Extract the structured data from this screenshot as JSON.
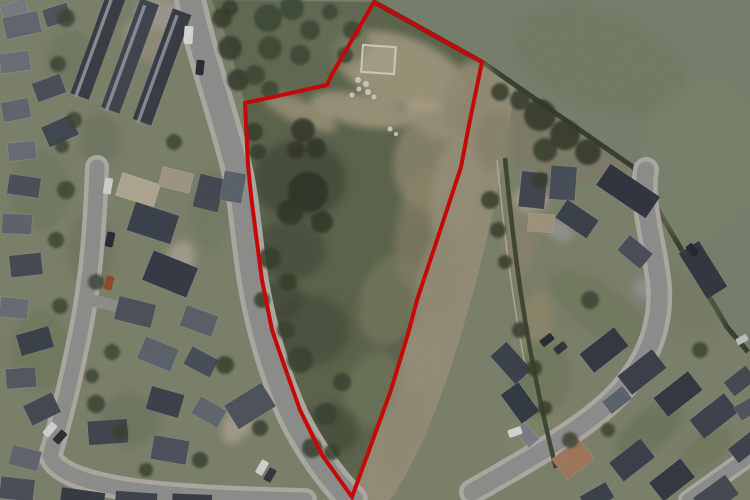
{
  "image": {
    "kind": "aerial-photograph",
    "width": 750,
    "height": 500
  },
  "palette": {
    "boundary_red": "#e30b0b",
    "pasture_green": "#87917a",
    "site_scrub": "#697257",
    "scrub_dark": "#49523d",
    "bare_earth": "#b6ab8e",
    "dry_grass_strip": "#a79f87",
    "road_grey": "#a1a19f",
    "roof_dark": "#3f4450",
    "garden_base": "#8d9279"
  },
  "site_boundary": {
    "stroke_width": "4",
    "points": "374,2 482,62 470,120 461,167 437,240 417,300 408,334 391,390 371,445 352,497 322,455 300,410 283,362 272,330 262,280 256,235 251,195 248,165 245,103 327,85 331,76"
  },
  "features": {
    "pasture": {
      "points": "360,0 750,0 750,352 727,327 700,270 660,205 633,167 482,62 374,2"
    },
    "pasture_hedge": {
      "d": "M374,2 L482,62 L633,167 L727,327 L748,352"
    },
    "scrub_north": {
      "points": "212,0 374,2 331,76 327,85 245,103 228,42"
    },
    "strip_triangle": {
      "points": "482,62 633,167 540,198 488,120"
    },
    "strip_brush": {
      "d": "M478,64 C470,140 452,230 424,322 C410,370 390,428 362,472"
    },
    "main_road": {
      "d": "M190,0 C202,55 220,105 235,162 C244,196 246,238 253,282 C261,328 274,374 293,416 C312,454 332,480 352,500"
    },
    "west_street": {
      "d": "M97,167 C95,225 91,285 77,348 C68,392 60,424 50,456 C58,476 100,488 170,494 C220,498 265,499 305,500"
    },
    "west_branch": {
      "d": "M90,300 L146,313"
    },
    "east_road": {
      "d": "M646,170 C640,205 656,248 659,288 C661,326 648,362 618,394 C588,426 532,458 472,492"
    },
    "spur_road": {
      "d": "M688,500 L750,456"
    },
    "east_hedge": {
      "d": "M505,158 C512,230 520,300 535,375 C544,420 550,445 556,468"
    },
    "east_fence": {
      "d": "M497,160 C504,232 512,300 527,375"
    }
  },
  "shapes": {
    "houses": [
      [
        2,
        2,
        26,
        18,
        -20,
        "#878c94"
      ],
      [
        4,
        14,
        36,
        22,
        -12,
        "#70757f"
      ],
      [
        44,
        6,
        26,
        18,
        -18,
        "#5a606b"
      ],
      [
        0,
        52,
        30,
        20,
        -8,
        "#7a7f88"
      ],
      [
        34,
        78,
        30,
        20,
        -20,
        "#555b66"
      ],
      [
        2,
        100,
        28,
        20,
        -10,
        "#6e747e"
      ],
      [
        44,
        120,
        32,
        22,
        -24,
        "#4c525d"
      ],
      [
        8,
        142,
        28,
        18,
        -6,
        "#767b84"
      ],
      [
        88,
        -8,
        20,
        108,
        20,
        "#43484f"
      ],
      [
        120,
        -2,
        20,
        116,
        20,
        "#4a4f58"
      ],
      [
        152,
        8,
        20,
        118,
        20,
        "#41464f"
      ],
      [
        92,
        -4,
        3,
        104,
        20,
        "#9aa0a8"
      ],
      [
        124,
        2,
        3,
        112,
        20,
        "#9aa0a8"
      ],
      [
        156,
        12,
        3,
        114,
        20,
        "#959ba3"
      ],
      [
        8,
        176,
        32,
        20,
        8,
        "#565c67"
      ],
      [
        2,
        214,
        30,
        20,
        2,
        "#6d727c"
      ],
      [
        10,
        254,
        32,
        22,
        -6,
        "#4f555f"
      ],
      [
        0,
        298,
        28,
        20,
        6,
        "#777c85"
      ],
      [
        18,
        330,
        34,
        22,
        -16,
        "#454b56"
      ],
      [
        6,
        368,
        30,
        20,
        -4,
        "#5f656f"
      ],
      [
        26,
        398,
        32,
        22,
        -26,
        "#50565f"
      ],
      [
        118,
        178,
        40,
        24,
        18,
        "#c7bda6"
      ],
      [
        160,
        170,
        32,
        20,
        14,
        "#b5ab94"
      ],
      [
        130,
        208,
        46,
        30,
        18,
        "#454b57"
      ],
      [
        146,
        258,
        48,
        32,
        22,
        "#3e4450"
      ],
      [
        116,
        300,
        38,
        24,
        14,
        "#575d68"
      ],
      [
        196,
        176,
        26,
        34,
        14,
        "#4f555e"
      ],
      [
        222,
        172,
        22,
        30,
        10,
        "#6a707a"
      ],
      [
        182,
        310,
        34,
        22,
        20,
        "#6a6f79"
      ],
      [
        140,
        342,
        36,
        24,
        22,
        "#6a707a"
      ],
      [
        186,
        352,
        30,
        20,
        28,
        "#545a65"
      ],
      [
        148,
        390,
        34,
        24,
        16,
        "#464c57"
      ],
      [
        194,
        402,
        30,
        20,
        30,
        "#6e747e"
      ],
      [
        152,
        438,
        36,
        24,
        10,
        "#575d68"
      ],
      [
        228,
        392,
        44,
        28,
        -32,
        "#5a6069"
      ],
      [
        88,
        420,
        40,
        24,
        -4,
        "#4a505b"
      ],
      [
        60,
        490,
        44,
        24,
        8,
        "#3e444f"
      ],
      [
        115,
        492,
        42,
        22,
        4,
        "#474d58"
      ],
      [
        172,
        494,
        40,
        20,
        2,
        "#3f4550"
      ],
      [
        10,
        448,
        30,
        20,
        14,
        "#6e747e"
      ],
      [
        0,
        478,
        34,
        22,
        6,
        "#555b66"
      ],
      [
        520,
        172,
        26,
        36,
        6,
        "#4a505c"
      ],
      [
        550,
        166,
        26,
        34,
        4,
        "#545a65"
      ],
      [
        598,
        178,
        60,
        26,
        34,
        "#383e49"
      ],
      [
        558,
        208,
        38,
        22,
        34,
        "#454b55"
      ],
      [
        528,
        214,
        26,
        18,
        4,
        "#b3a78d"
      ],
      [
        676,
        258,
        54,
        24,
        58,
        "#3a404b"
      ],
      [
        620,
        242,
        30,
        20,
        40,
        "#555b66"
      ],
      [
        582,
        338,
        44,
        24,
        -38,
        "#3b414c"
      ],
      [
        620,
        360,
        44,
        24,
        -38,
        "#434955"
      ],
      [
        656,
        382,
        44,
        24,
        -38,
        "#3b414c"
      ],
      [
        692,
        404,
        44,
        24,
        -38,
        "#474d58"
      ],
      [
        604,
        392,
        26,
        16,
        -38,
        "#6a707a"
      ],
      [
        726,
        372,
        28,
        18,
        -38,
        "#50565f"
      ],
      [
        492,
        352,
        38,
        22,
        48,
        "#454b56"
      ],
      [
        502,
        392,
        36,
        22,
        54,
        "#3d434e"
      ],
      [
        516,
        428,
        22,
        14,
        48,
        "#8b9096"
      ],
      [
        556,
        446,
        34,
        26,
        -38,
        "#b5886a"
      ],
      [
        612,
        448,
        40,
        24,
        -38,
        "#434955"
      ],
      [
        652,
        468,
        40,
        24,
        -38,
        "#3b414c"
      ],
      [
        696,
        484,
        40,
        24,
        -36,
        "#50565f"
      ],
      [
        730,
        438,
        30,
        18,
        -38,
        "#474d58"
      ],
      [
        582,
        488,
        30,
        18,
        -30,
        "#454b56"
      ],
      [
        736,
        400,
        24,
        16,
        -30,
        "#5c626c"
      ]
    ],
    "patches": [
      [
        400,
        70,
        70,
        34,
        20,
        "#b6ab8e",
        0.9
      ],
      [
        360,
        110,
        50,
        16,
        12,
        "#bdb294",
        0.8
      ],
      [
        300,
        112,
        40,
        12,
        25,
        "#b2a78a",
        0.8
      ],
      [
        432,
        120,
        30,
        16,
        30,
        "#c3b79a",
        0.8
      ],
      [
        430,
        160,
        36,
        50,
        10,
        "#a89e83",
        0.7
      ],
      [
        420,
        230,
        24,
        60,
        8,
        "#a29877",
        0.55
      ],
      [
        390,
        300,
        30,
        46,
        14,
        "#8d9070",
        0.6
      ],
      [
        372,
        390,
        26,
        40,
        18,
        "#87906e",
        0.5
      ],
      [
        300,
        180,
        46,
        40,
        0,
        "#49523d",
        0.75
      ],
      [
        290,
        250,
        36,
        30,
        0,
        "#4d5741",
        0.7
      ],
      [
        310,
        330,
        40,
        36,
        0,
        "#4b5540",
        0.6
      ],
      [
        330,
        430,
        30,
        26,
        0,
        "#49533e",
        0.6
      ],
      [
        280,
        300,
        24,
        20,
        0,
        "#434d39",
        0.6
      ],
      [
        470,
        100,
        26,
        40,
        12,
        "#a59d84",
        0.9
      ],
      [
        455,
        190,
        24,
        56,
        10,
        "#aaa189",
        0.9
      ],
      [
        440,
        280,
        22,
        56,
        12,
        "#a59d84",
        0.85
      ],
      [
        425,
        360,
        20,
        48,
        16,
        "#a89f86",
        0.85
      ],
      [
        405,
        430,
        18,
        40,
        22,
        "#a49b82",
        0.8
      ],
      [
        495,
        140,
        20,
        30,
        10,
        "#979478",
        0.8
      ],
      [
        520,
        240,
        16,
        40,
        6,
        "#9c957c",
        0.8
      ],
      [
        535,
        330,
        16,
        40,
        10,
        "#a09879",
        0.8
      ],
      [
        548,
        410,
        14,
        34,
        12,
        "#9d9579",
        0.8
      ],
      [
        530,
        440,
        30,
        24,
        0,
        "#8f9778",
        0.9
      ],
      [
        162,
        14,
        26,
        16,
        14,
        "#b2aea4",
        0.9
      ],
      [
        150,
        40,
        30,
        20,
        20,
        "#b5ab97",
        0.5
      ],
      [
        280,
        30,
        40,
        30,
        0,
        "#6f7a5e",
        0.8
      ],
      [
        340,
        40,
        30,
        26,
        0,
        "#747f62",
        0.7
      ],
      [
        600,
        60,
        90,
        50,
        20,
        "#808a72",
        0.5
      ],
      [
        700,
        160,
        60,
        80,
        10,
        "#8d967e",
        0.5
      ],
      [
        680,
        300,
        50,
        30,
        40,
        "#7f8971",
        0.4
      ],
      [
        600,
        310,
        60,
        24,
        35,
        "#7f8a6b",
        0.8
      ],
      [
        540,
        380,
        30,
        40,
        10,
        "#7e896a",
        0.8
      ],
      [
        650,
        430,
        40,
        20,
        -38,
        "#788365",
        0.7
      ],
      [
        706,
        450,
        30,
        16,
        -38,
        "#7d886a",
        0.7
      ],
      [
        40,
        190,
        30,
        40,
        0,
        "#7e896c",
        0.7
      ],
      [
        90,
        250,
        24,
        36,
        0,
        "#79846a",
        0.6
      ],
      [
        40,
        350,
        30,
        40,
        0,
        "#7c876a",
        0.7
      ],
      [
        130,
        420,
        30,
        26,
        0,
        "#76816a",
        0.6
      ],
      [
        210,
        210,
        20,
        40,
        0,
        "#7f8a6e",
        0.6
      ],
      [
        70,
        60,
        24,
        30,
        0,
        "#7b866c",
        0.6
      ],
      [
        100,
        140,
        20,
        26,
        0,
        "#76816a",
        0.6
      ],
      [
        240,
        420,
        14,
        26,
        30,
        "#b9b2a0",
        0.9
      ],
      [
        180,
        260,
        14,
        20,
        20,
        "#c0b8a4",
        0.8
      ],
      [
        530,
        200,
        18,
        12,
        5,
        "#bdb49c",
        0.8
      ],
      [
        650,
        288,
        16,
        13,
        0,
        "#a2a2a0",
        1
      ],
      [
        560,
        230,
        14,
        10,
        30,
        "#a8a8a4",
        0.9
      ]
    ],
    "trees": [
      [
        222,
        18,
        10,
        "#3c4634"
      ],
      [
        230,
        48,
        12,
        "#3c4634"
      ],
      [
        238,
        80,
        11,
        "#3c4634"
      ],
      [
        230,
        8,
        8,
        "#3c4634"
      ],
      [
        254,
        132,
        9,
        "#3c4634"
      ],
      [
        258,
        152,
        8,
        "#3c4634"
      ],
      [
        268,
        18,
        14,
        "#47523c"
      ],
      [
        292,
        8,
        12,
        "#47523c"
      ],
      [
        310,
        30,
        10,
        "#47523c"
      ],
      [
        270,
        48,
        12,
        "#47523c"
      ],
      [
        330,
        12,
        8,
        "#47523c"
      ],
      [
        352,
        30,
        9,
        "#47523c"
      ],
      [
        345,
        55,
        8,
        "#47523c"
      ],
      [
        300,
        55,
        10,
        "#47523c"
      ],
      [
        255,
        75,
        10,
        "#47523c"
      ],
      [
        270,
        90,
        9,
        "#47523c"
      ],
      [
        303,
        130,
        12,
        "#39412f"
      ],
      [
        316,
        148,
        10,
        "#39412f"
      ],
      [
        296,
        150,
        9,
        "#39412f"
      ],
      [
        308,
        192,
        20,
        "#343c2c"
      ],
      [
        290,
        212,
        13,
        "#39412f"
      ],
      [
        322,
        222,
        11,
        "#39412f"
      ],
      [
        270,
        258,
        11,
        "#3f4834"
      ],
      [
        288,
        282,
        9,
        "#3f4834"
      ],
      [
        262,
        300,
        8,
        "#3f4834"
      ],
      [
        300,
        360,
        13,
        "#434d38"
      ],
      [
        326,
        414,
        11,
        "#434d38"
      ],
      [
        286,
        330,
        9,
        "#434d38"
      ],
      [
        342,
        382,
        9,
        "#434d38"
      ],
      [
        312,
        448,
        10,
        "#434d38"
      ],
      [
        332,
        452,
        8,
        "#434d38"
      ],
      [
        225,
        365,
        9,
        "#414a36"
      ],
      [
        260,
        428,
        8,
        "#414a36"
      ],
      [
        500,
        92,
        9,
        "#3f4834"
      ],
      [
        540,
        115,
        16,
        "#39412f"
      ],
      [
        565,
        135,
        15,
        "#39412f"
      ],
      [
        588,
        152,
        13,
        "#39412f"
      ],
      [
        545,
        150,
        12,
        "#3f4834"
      ],
      [
        520,
        100,
        10,
        "#3f4834"
      ],
      [
        540,
        180,
        8,
        "#3f4834"
      ],
      [
        490,
        200,
        9,
        "#3f4834"
      ],
      [
        498,
        230,
        8,
        "#3f4834"
      ],
      [
        505,
        262,
        7,
        "#3f4834"
      ],
      [
        520,
        330,
        8,
        "#3f4834"
      ],
      [
        534,
        368,
        8,
        "#3f4834"
      ],
      [
        545,
        408,
        7,
        "#3f4834"
      ],
      [
        570,
        440,
        8,
        "#46503c"
      ],
      [
        608,
        430,
        7,
        "#46503c"
      ],
      [
        700,
        350,
        8,
        "#46503c"
      ],
      [
        590,
        300,
        9,
        "#46503c"
      ],
      [
        96,
        404,
        9,
        "#434d38"
      ],
      [
        120,
        432,
        8,
        "#434d38"
      ],
      [
        200,
        460,
        8,
        "#434d38"
      ],
      [
        146,
        470,
        7,
        "#434d38"
      ],
      [
        66,
        190,
        9,
        "#47523c"
      ],
      [
        56,
        240,
        8,
        "#47523c"
      ],
      [
        96,
        282,
        8,
        "#47523c"
      ],
      [
        60,
        306,
        8,
        "#47523c"
      ],
      [
        112,
        352,
        8,
        "#47523c"
      ],
      [
        92,
        376,
        7,
        "#47523c"
      ],
      [
        66,
        18,
        9,
        "#47523c"
      ],
      [
        58,
        64,
        8,
        "#47523c"
      ],
      [
        74,
        120,
        8,
        "#47523c"
      ],
      [
        62,
        146,
        7,
        "#47523c"
      ],
      [
        174,
        142,
        8,
        "#47523c"
      ]
    ],
    "cars": [
      [
        184,
        26,
        9,
        18,
        4,
        "#f2f2f0"
      ],
      [
        196,
        60,
        8,
        15,
        6,
        "#30343c"
      ],
      [
        104,
        178,
        8,
        16,
        10,
        "#eceae6"
      ],
      [
        106,
        232,
        8,
        15,
        12,
        "#2e323a"
      ],
      [
        105,
        276,
        8,
        14,
        14,
        "#a5552f"
      ],
      [
        46,
        422,
        8,
        15,
        40,
        "#ececea"
      ],
      [
        56,
        430,
        8,
        14,
        42,
        "#34383f"
      ],
      [
        258,
        460,
        8,
        15,
        30,
        "#ececea"
      ],
      [
        266,
        468,
        8,
        14,
        30,
        "#3c4048"
      ],
      [
        508,
        428,
        14,
        8,
        -20,
        "#efefec"
      ],
      [
        540,
        336,
        14,
        8,
        -38,
        "#2f333b"
      ],
      [
        554,
        344,
        13,
        8,
        -38,
        "#3a3e46"
      ],
      [
        686,
        246,
        13,
        8,
        50,
        "#2c3038"
      ],
      [
        736,
        336,
        12,
        7,
        -30,
        "#d8d8d4"
      ]
    ],
    "white_marks": {
      "rects": [
        [
          362,
          46,
          33,
          27,
          4
        ]
      ],
      "dots": [
        [
          358,
          80,
          3
        ],
        [
          366,
          84,
          3
        ],
        [
          359,
          89,
          2.5
        ],
        [
          368,
          92,
          3
        ],
        [
          352,
          95,
          2.5
        ],
        [
          374,
          97,
          2.5
        ],
        [
          390,
          129,
          2.5
        ],
        [
          396,
          134,
          2
        ]
      ]
    }
  }
}
